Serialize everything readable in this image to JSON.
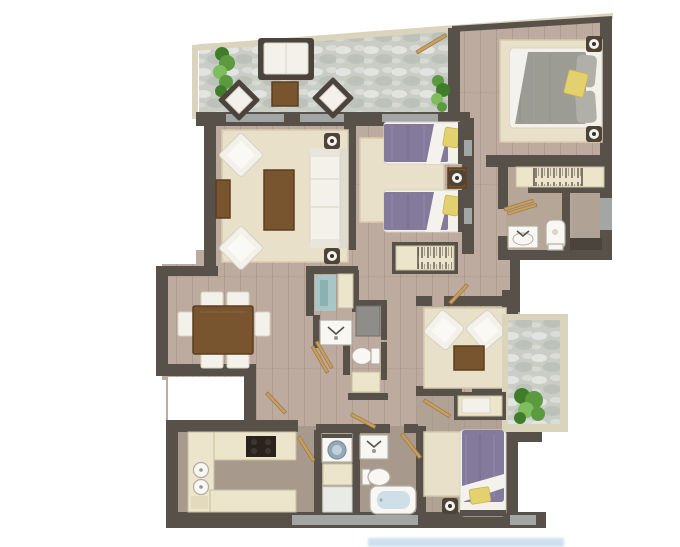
{
  "page": {
    "kind": "apartment-floor-plan-render",
    "canvas": {
      "width": 680,
      "height": 547
    }
  },
  "colors": {
    "wall": "#57514a",
    "trim": "#dbd4bd",
    "glass": "#a2a7a5",
    "wood": "#bcab9e",
    "taupe": "#a79a8c",
    "floor_b3": "#b0a294",
    "floor_bath1": "#b5a698",
    "stone": "#c9cdc6",
    "rug": "#e8e0c9",
    "rug_border": "#d5cbae",
    "cream": "#ece4cb",
    "cream_border": "#c9bf9f",
    "white_f": "#f3f1ea",
    "white_f_border": "#d7d2c4",
    "dark_frame": "#4b443c",
    "table_wood": "#78552f",
    "table_wood_dark": "#5c3f1e",
    "purple": "#847a9b",
    "purple_light": "#968db1",
    "gray_bed": "#9c9c95",
    "gray_bed_light": "#b0b0a9",
    "yellow": "#e3d06e",
    "yellow_dark": "#c9b44e",
    "plant": "#5c9a40",
    "plant_dark": "#417c2b",
    "plant_light": "#7fbd5d",
    "teal": "#a7c6c5",
    "teal_dark": "#8bb1b0",
    "tan": "#c89f63",
    "tan_dark": "#a37c42",
    "fixture": "#f8f7f4",
    "fixture_border": "#b3ada3",
    "tub_water": "#cfdfe8",
    "drum": "#93a9b6",
    "tile": "#e9ebe7",
    "watermark": "#7fb0d6"
  },
  "rooms": [
    {
      "name": "terrace",
      "items": [
        "outdoor-sofa",
        "outdoor-coffee-table",
        "lounge-chair",
        "lounge-chair",
        "plant",
        "plant"
      ]
    },
    {
      "name": "master-bedroom",
      "items": [
        "double-bed",
        "rug",
        "nightstand-lamp",
        "nightstand-lamp"
      ]
    },
    {
      "name": "ensuite-bathroom",
      "items": [
        "wardrobe",
        "washbasin",
        "toilet",
        "shower-bench",
        "towel-rail",
        "glass-door"
      ]
    },
    {
      "name": "twin-bedroom",
      "items": [
        "single-bed",
        "single-bed",
        "nightstand-lamp",
        "rug",
        "wardrobe"
      ]
    },
    {
      "name": "living-room",
      "items": [
        "sofa",
        "coffee-table",
        "armchair",
        "armchair",
        "side-table",
        "floor-lamp",
        "floor-lamp",
        "rug"
      ]
    },
    {
      "name": "dining-area",
      "items": [
        "dining-table",
        "chair",
        "chair",
        "chair",
        "chair",
        "chair",
        "chair"
      ]
    },
    {
      "name": "central-bathroom",
      "items": [
        "shower",
        "washbasin",
        "toilet",
        "cabinet",
        "cabinet"
      ]
    },
    {
      "name": "sitting-area",
      "items": [
        "armchair",
        "armchair",
        "coffee-table",
        "rug"
      ]
    },
    {
      "name": "balcony",
      "items": [
        "plant"
      ]
    },
    {
      "name": "bedroom",
      "items": [
        "single-bed",
        "rug",
        "nightstand-lamp",
        "closet-bench",
        "door"
      ]
    },
    {
      "name": "bathroom",
      "items": [
        "bathtub",
        "washbasin",
        "toilet"
      ]
    },
    {
      "name": "laundry",
      "items": [
        "washing-machine",
        "cabinet",
        "tile-floor"
      ]
    },
    {
      "name": "kitchen",
      "items": [
        "u-shaped-counter",
        "cooktop",
        "double-sink",
        "mat",
        "door"
      ]
    }
  ],
  "watermark": {
    "present": true,
    "legible": false
  }
}
